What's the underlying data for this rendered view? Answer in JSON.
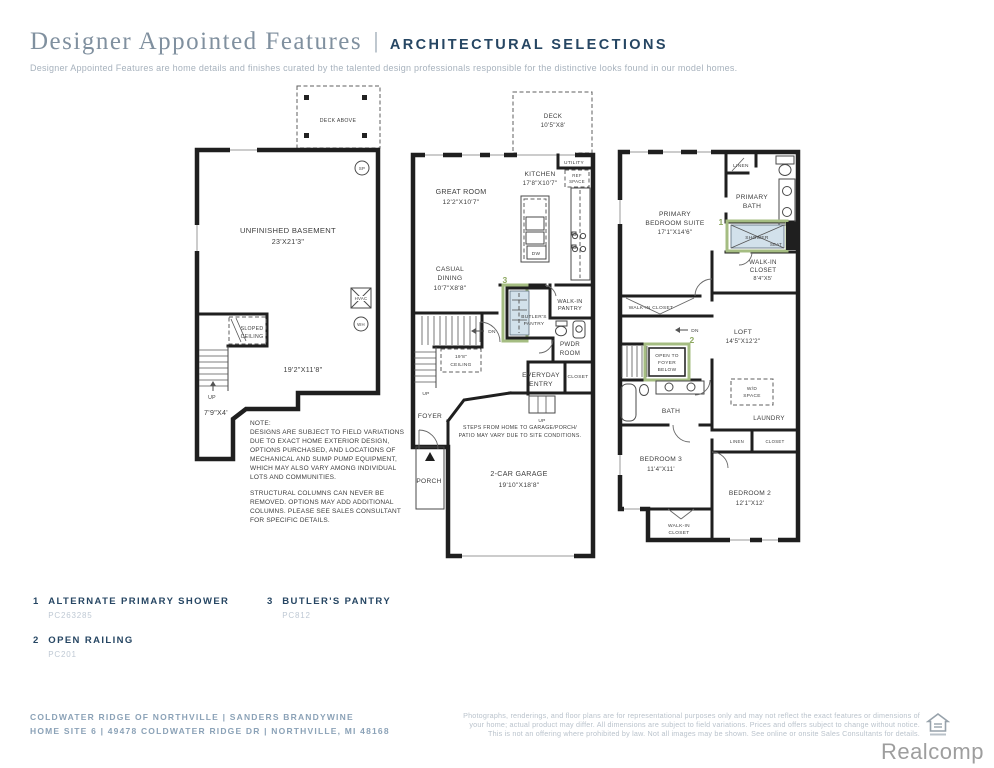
{
  "colors": {
    "accent_green": "#a5bd82",
    "marker_green": "#8ca75f",
    "highlight_fill": "#d2e1eb",
    "navy": "#264663",
    "title_gray": "#80909f",
    "wall": "#1f1f1f"
  },
  "header": {
    "title": "Designer Appointed Features",
    "divider": "|",
    "subtitle_caps": "ARCHITECTURAL SELECTIONS",
    "tagline": "Designer Appointed Features are home details and finishes curated by the talented design professionals responsible for the distinctive looks found in our model homes."
  },
  "basement": {
    "deck_above": "DECK ABOVE",
    "sp": "SP",
    "room1": "UNFINISHED BASEMENT",
    "room1_dim": "23'X21'3\"",
    "hvac": "HVAC",
    "wh": "WH",
    "sloped1": "SLOPED",
    "sloped2": "CEILING",
    "up": "UP",
    "dim2": "19'2\"X11'8\"",
    "dim3": "7'9\"X4'",
    "note_lines": [
      "NOTE:",
      "DESIGNS ARE SUBJECT TO FIELD VARIATIONS",
      "DUE TO EXACT HOME EXTERIOR DESIGN,",
      "OPTIONS PURCHASED, AND LOCATIONS OF",
      "MECHANICAL AND SUMP PUMP EQUIPMENT,",
      "WHICH MAY ALSO VARY AMONG INDIVIDUAL",
      "LOTS AND COMMUNITIES.",
      "STRUCTURAL COLUMNS CAN NEVER BE",
      "REMOVED. OPTIONS MAY ADD ADDITIONAL",
      "COLUMNS. PLEASE SEE SALES CONSULTANT",
      "FOR SPECIFIC DETAILS."
    ]
  },
  "first_floor": {
    "deck1": "DECK",
    "deck2": "10'5\"X8'",
    "utility": "UTILITY",
    "ref1": "REF",
    "ref2": "SPACE",
    "kitchen1": "KITCHEN",
    "kitchen2": "17'8\"X10'7\"",
    "great1": "GREAT ROOM",
    "great2": "12'2\"X10'7\"",
    "dw": "DW",
    "casual1": "CASUAL",
    "casual2": "DINING",
    "casual3": "10'7\"X8'8\"",
    "marker3": "3",
    "butlers1": "BUTLER'S",
    "butlers2": "PANTRY",
    "wip1": "WALK-IN",
    "wip2": "PANTRY",
    "pwdr1": "PWDR",
    "pwdr2": "ROOM",
    "ceil1": "19'8\"",
    "ceil2": "CEILING",
    "dn": "DN",
    "up_stairs": "UP",
    "up_entry": "UP",
    "every1": "EVERYDAY",
    "every2": "ENTRY",
    "closet": "CLOSET",
    "foyer": "FOYER",
    "steps1": "STEPS FROM HOME TO GARAGE/PORCH/",
    "steps2": "PATIO MAY VARY DUE TO SITE CONDITIONS.",
    "porch": "PORCH",
    "garage1": "2-CAR GARAGE",
    "garage2": "19'10\"X18'8\""
  },
  "second_floor": {
    "linen": "LINEN",
    "pbath1": "PRIMARY",
    "pbath2": "BATH",
    "suite1": "PRIMARY",
    "suite2": "BEDROOM SUITE",
    "suite3": "17'1\"X14'6\"",
    "marker1": "1",
    "shower": "SHOWER",
    "seat": "SEAT",
    "wic1": "WALK-IN",
    "wic2": "CLOSET",
    "wic3": "8'4\"X5'",
    "wic_small": "WALK-IN CLOSET",
    "dn": "DN",
    "marker2": "2",
    "loft1": "LOFT",
    "loft2": "14'5\"X12'2\"",
    "open1": "OPEN TO",
    "open2": "FOYER",
    "open3": "BELOW",
    "bath": "BATH",
    "wd1": "W/D",
    "wd2": "SPACE",
    "laundry": "LAUNDRY",
    "linen2": "LINEN",
    "closet2": "CLOSET",
    "bed3a": "BEDROOM 3",
    "bed3b": "11'4\"X11'",
    "bed2a": "BEDROOM 2",
    "bed2b": "12'1\"X12'",
    "wicb1": "WALK-IN",
    "wicb2": "CLOSET"
  },
  "legend": {
    "items": [
      {
        "num": "1",
        "label": "ALTERNATE PRIMARY SHOWER",
        "code": "PC263285"
      },
      {
        "num": "2",
        "label": "OPEN RAILING",
        "code": "PC201"
      },
      {
        "num": "3",
        "label": "BUTLER'S PANTRY",
        "code": "PC812"
      }
    ]
  },
  "footer": {
    "line1": "COLDWATER RIDGE OF NORTHVILLE | SANDERS BRANDYWINE",
    "line2": "HOME SITE 6 | 49478 COLDWATER RIDGE DR | NORTHVILLE, MI 48168",
    "disclaimer": [
      "Photographs, renderings, and floor plans are for representational purposes only and may not reflect the exact features or dimensions of",
      "your home; actual product may differ. All dimensions are subject to field variations. Prices and offers subject to change without notice.",
      "This is not an offering where prohibited by law. Not all images may be shown. See online or onsite Sales Consultants for details."
    ],
    "watermark": "Realcomp"
  }
}
